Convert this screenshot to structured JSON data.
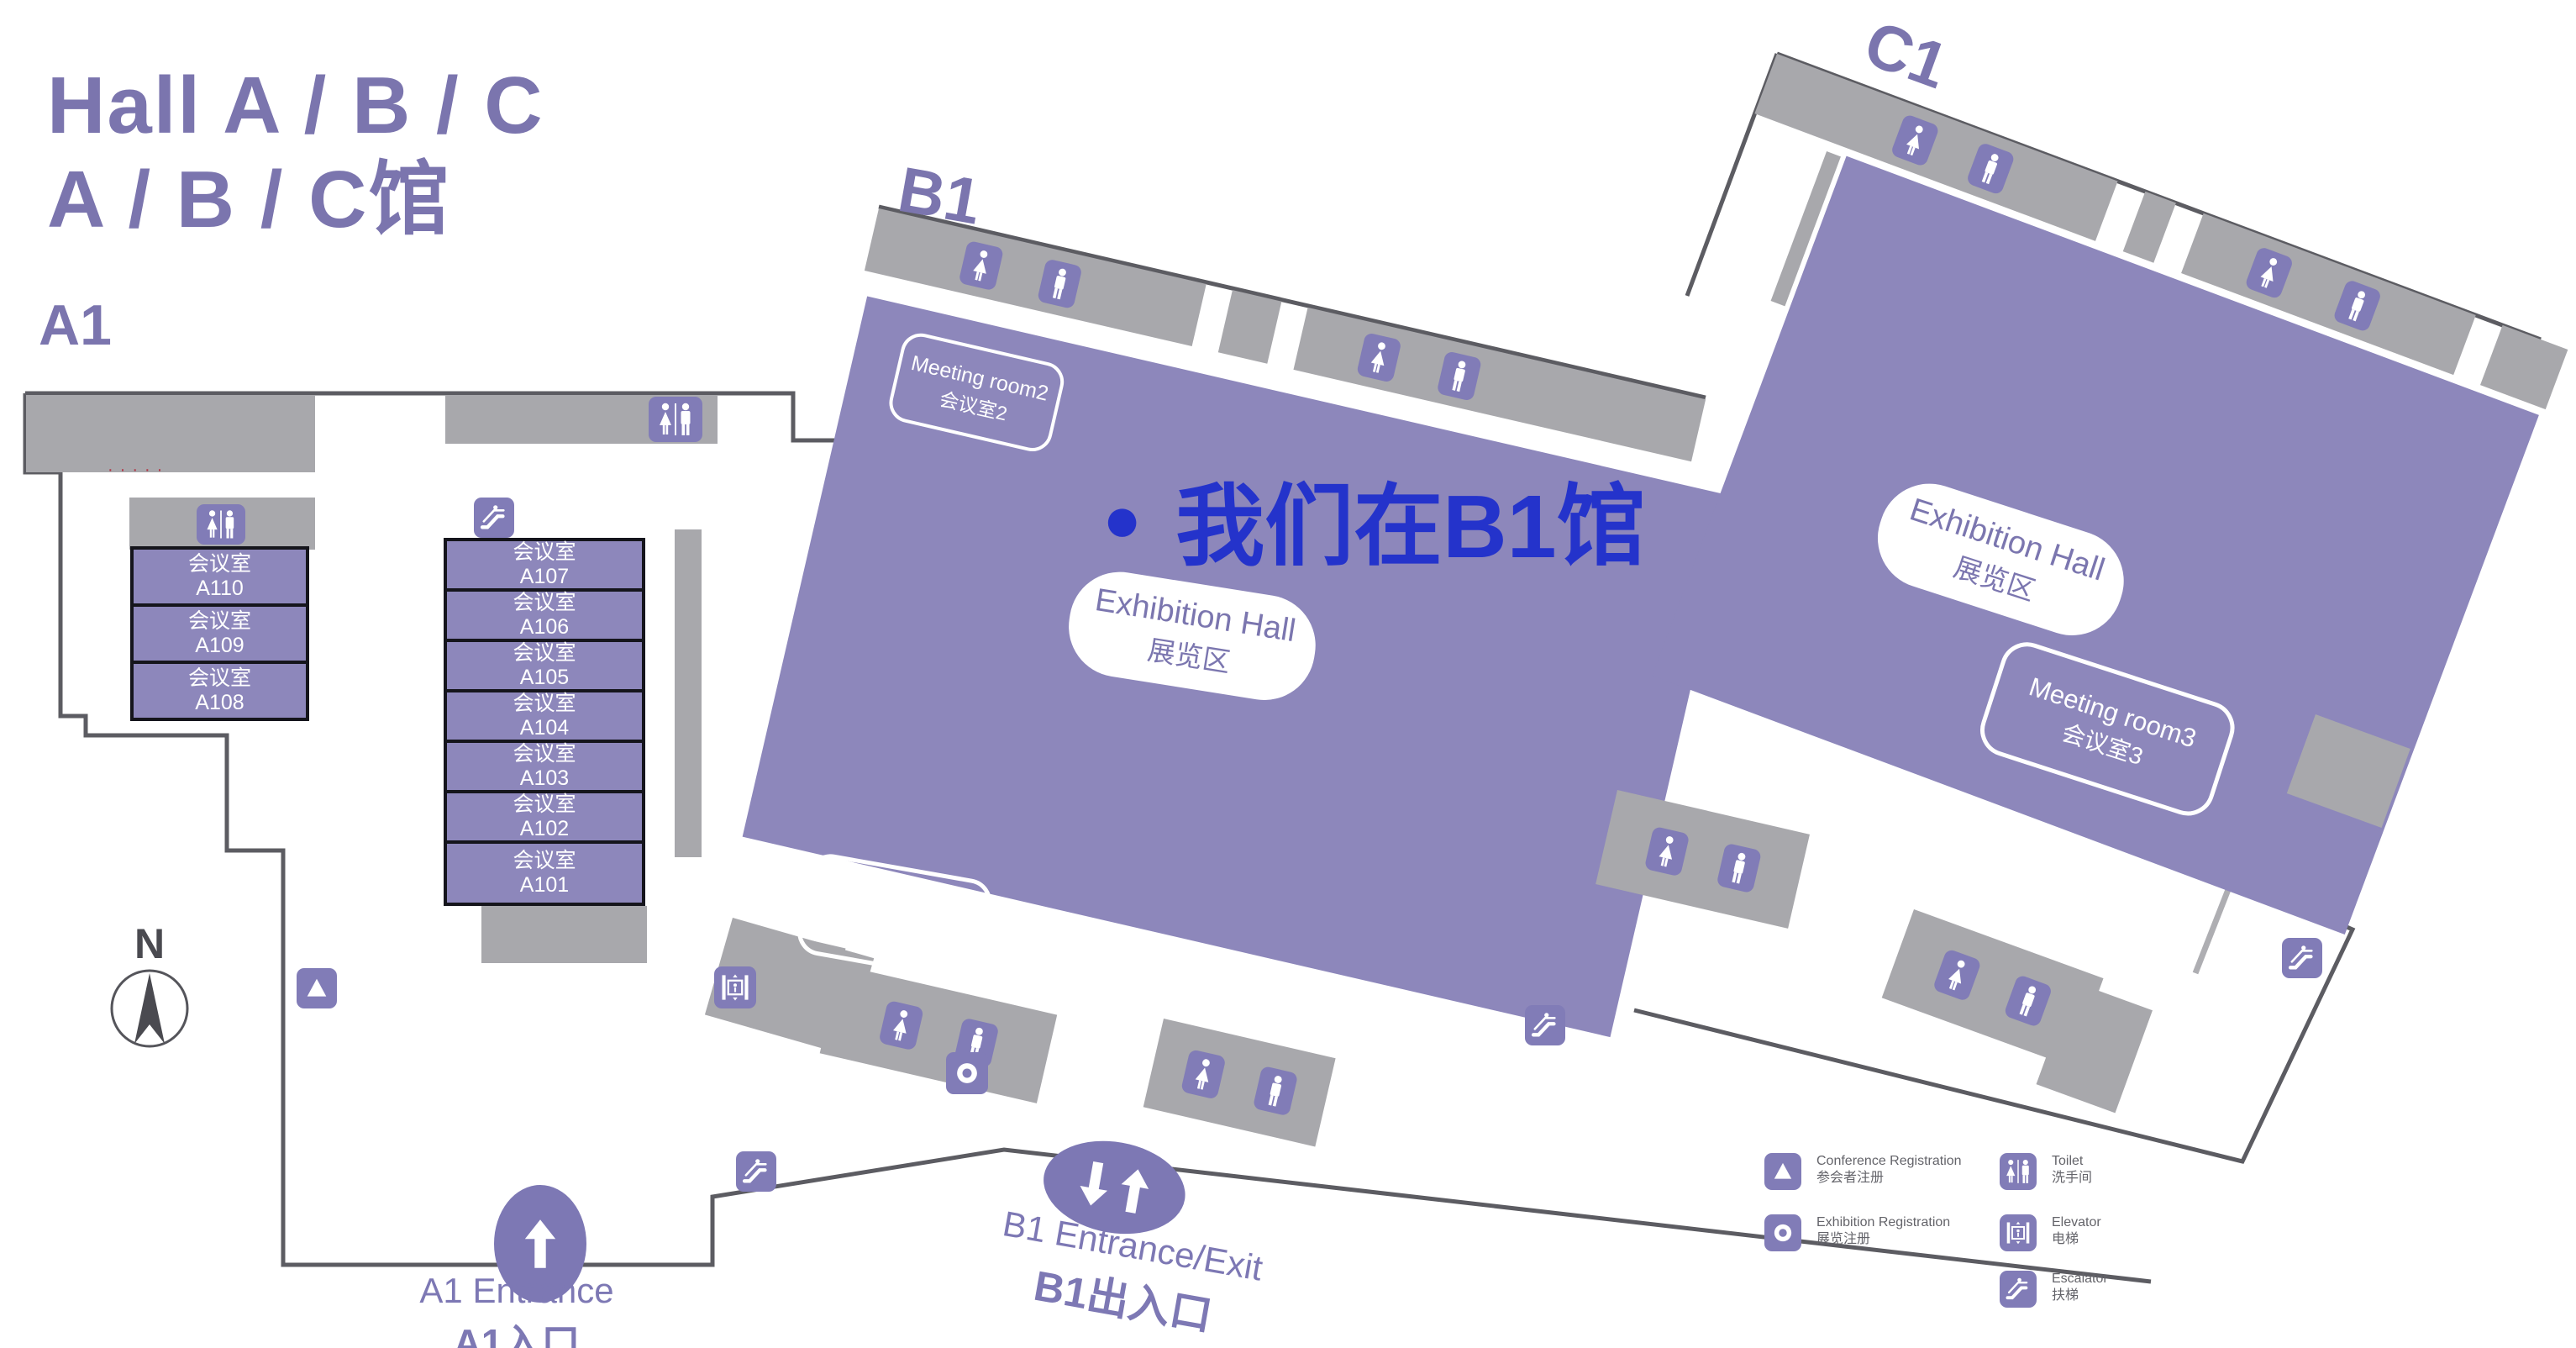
{
  "title": {
    "line1": "Hall A / B / C",
    "line2": "A / B / C馆"
  },
  "area_labels": {
    "a1": "A1",
    "b1": "B1",
    "c1": "C1"
  },
  "highlight": {
    "bullet": "●",
    "label": "我们在B1馆",
    "color": "#2433cb"
  },
  "rooms_left": [
    {
      "name": "会议室",
      "id": "A110"
    },
    {
      "name": "会议室",
      "id": "A109"
    },
    {
      "name": "会议室",
      "id": "A108"
    }
  ],
  "rooms_mid": [
    {
      "name": "会议室",
      "id": "A107"
    },
    {
      "name": "会议室",
      "id": "A106"
    },
    {
      "name": "会议室",
      "id": "A105"
    },
    {
      "name": "会议室",
      "id": "A104"
    },
    {
      "name": "会议室",
      "id": "A103"
    },
    {
      "name": "会议室",
      "id": "A102"
    },
    {
      "name": "会议室",
      "id": "A101"
    }
  ],
  "halls": {
    "b1": {
      "line1": "Exhibition Hall",
      "line2": "展览区"
    },
    "c1": {
      "line1": "Exhibition Hall",
      "line2": "展览区"
    }
  },
  "meeting_rooms": {
    "m1": {
      "line1": "Meeting room1",
      "line2": "会议室1"
    },
    "m2": {
      "line1": "Meeting room2",
      "line2": "会议室2"
    },
    "m3": {
      "line1": "Meeting room3",
      "line2": "会议室3"
    }
  },
  "entrances": {
    "a1": {
      "line1": "A1 Entrance",
      "line2": "A1入口"
    },
    "b1": {
      "line1": "B1 Entrance/Exit",
      "line2": "B1出入口"
    }
  },
  "compass": {
    "label": "N"
  },
  "clipped_red_text": "·····",
  "legend": [
    {
      "icon": "conference-registration-icon",
      "line1": "Conference Registration",
      "line2": "参会者注册"
    },
    {
      "icon": "exhibition-registration-icon",
      "line1": "Exhibition Registration",
      "line2": "展览注册"
    },
    {
      "icon": "toilet-icon",
      "line1": "Toilet",
      "line2": "洗手间"
    },
    {
      "icon": "elevator-icon",
      "line1": "Elevator",
      "line2": "电梯"
    },
    {
      "icon": "escalator-icon",
      "line1": "Escalator",
      "line2": "扶梯"
    }
  ],
  "colors": {
    "hall_purple": "#8d87bb",
    "corridor_gray": "#a8a8ac",
    "icon_purple": "#817cb7",
    "outline": "#5c5c62",
    "title_purple": "#7b75ae",
    "highlight_blue": "#2433cb"
  }
}
